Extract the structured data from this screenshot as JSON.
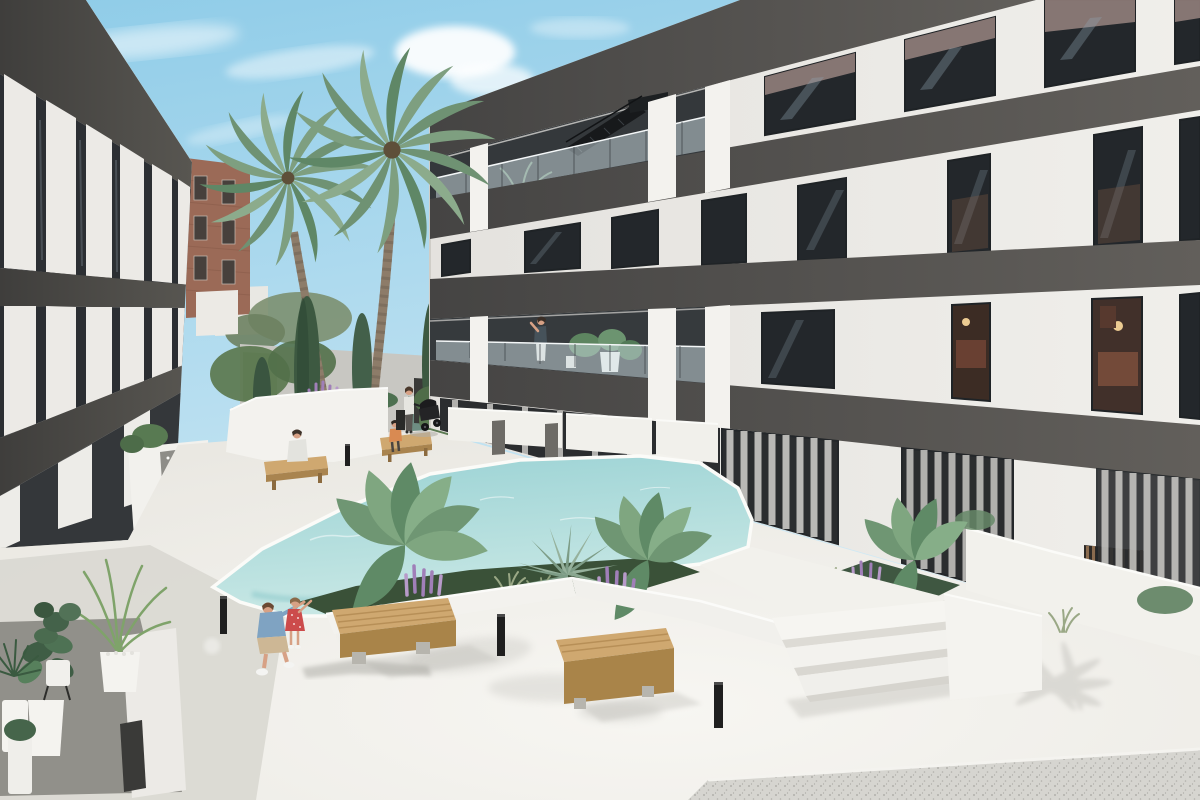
{
  "meta": {
    "title": "New-build apartment complex courtyard - photorealistic architectural render",
    "type": "3d-architectural-visualization",
    "width_px": 1200,
    "height_px": 800,
    "visible_text": "none"
  },
  "palette": {
    "sky_top": "#8fcce8",
    "sky_horizon": "#ddeff7",
    "cloud_white": "#ffffff",
    "facade_white": "#f0efeb",
    "facade_shade": "#e4e2de",
    "pillar_white": "#f3f2ee",
    "band_dark": "#454443",
    "band_lit": "#625f5b",
    "band_left_dark": "#3f3e3c",
    "band_left_lit": "#585651",
    "recess_dark": "#34383b",
    "window_glass": "#23272b",
    "window_reflection": "#8fa2b0",
    "sky_reflection_pink": "#d9b8ae",
    "interior_warm": "#3c2c24",
    "interior_furniture": "#6e4334",
    "interior_lamp": "#eccb92",
    "curtain_white": "#eae8e3",
    "glass_balustrade": "#cfe0e6",
    "pavement": "#e9e7e1",
    "pavement_bright": "#f7f6f2",
    "pavement_shadow": "#d9d8d2",
    "terrazzo_gray": "#d6d5d0",
    "pool_far": "#9ad2d4",
    "pool_near": "#c9e8e5",
    "pool_edge_aqua": "#7cc0c3",
    "coping_white": "#fbfbf8",
    "planter_white": "#f3f2ee",
    "bed_green": "#3a5138",
    "palm_green": "#7e9f80",
    "palm_green_dark": "#5f8766",
    "cypress_green": "#3d5941",
    "banana_green": "#6f9673",
    "agave_green": "#96b19c",
    "lupine_purple": "#b095c5",
    "grass_green": "#9aa886",
    "wood_top": "#cfa870",
    "wood_side": "#a98449",
    "concrete_gray": "#b7b5ae",
    "brick_red": "#9b6a57",
    "bg_wall_gray": "#c8c7c2",
    "hedge_green": "#7a9268",
    "teal_panel": "#6e8d82",
    "louver_wood": "#8a6b4e",
    "bollard_black": "#1f1f1f",
    "terrace_gray": "#91908a",
    "pot_white": "#f4f3ef",
    "skin": "#d7a185",
    "denim_blue": "#7fa3c2",
    "khaki": "#cdb795",
    "dress_red": "#cc4b4b",
    "orange_top": "#d98a52",
    "stroller_black": "#1c1c1e"
  },
  "scene": {
    "time_of_day": "sunny midday, long soft shadows toward lower-right",
    "sky": {
      "visible_region": "upper-left wedge between buildings",
      "clouds": 5
    },
    "buildings": {
      "left_wing": {
        "position": "left edge, seen at sharp angle receding right",
        "floors_visible": 3,
        "features": [
          "dark charcoal floor bands",
          "white vertical fins",
          "full-height glazing",
          "ground-floor terraces with white planter boxes"
        ]
      },
      "main_wing": {
        "position": "center to right, facade facing courtyard",
        "floors_visible": 4,
        "features": [
          "dark charcoal parapet and floor bands",
          "white piers",
          "glass balustrade balconies on top and second floor (left half)",
          "external black staircase on top floor",
          "floor-to-ceiling windows",
          "two warm-lit interiors on right",
          "ground-floor patios with low white walls",
          "wood louver screen",
          "white courtyard wall lower right"
        ]
      },
      "background": {
        "brick_building": {
          "color": "red-brown",
          "windows": 6
        },
        "misc": [
          "distant white building",
          "gray service walls",
          "green hedge panel",
          "teal panel",
          "dark doorway",
          "white utility boxes",
          "background trees"
        ]
      }
    },
    "courtyard": {
      "paving": "white concrete, terrazzo speckled strip lower right",
      "pool": {
        "shape": "irregular angular",
        "water": "turquoise",
        "coping": "white",
        "raised_deck_steps": 3
      },
      "planters": [
        "left planter with cypresses, lupines and boxwood ball",
        "central white wedge planter with bananas, agave, lupines, grasses",
        "right bed near steps"
      ],
      "benches": [
        {
          "id": "bench-left",
          "type": "wood slat",
          "occupant": "seated person"
        },
        {
          "id": "bench-mid",
          "type": "wood slat",
          "occupant": "seated child"
        },
        {
          "id": "bench-front-large",
          "type": "chunky wood block on concrete feet"
        },
        {
          "id": "bench-front-long",
          "type": "long wood slat on concrete feet"
        }
      ],
      "bollard_lights": 4,
      "potted_plants_lower_left": 6
    },
    "people": [
      {
        "id": "crouching-man",
        "desc": "man in blue shirt and khaki shorts crouching, pointing up-right",
        "area": "foreground center-left"
      },
      {
        "id": "little-girl",
        "desc": "girl in red polka-dot dress next to man",
        "area": "foreground center-left"
      },
      {
        "id": "bench-sitter",
        "desc": "person seated on left bench, back to camera",
        "area": "mid-left"
      },
      {
        "id": "bench-child",
        "desc": "child in orange top on middle bench",
        "area": "mid"
      },
      {
        "id": "stroller-woman",
        "desc": "woman standing beside black pram",
        "area": "mid walkway"
      },
      {
        "id": "balcony-woman",
        "desc": "woman standing at second-floor balcony rail",
        "area": "main building"
      }
    ],
    "vegetation": [
      "2 large date palms",
      "3 cypresses",
      "3 banana plants",
      "1 agave",
      "4 lupine clusters",
      "grass tufts",
      "areca palm in pot",
      "monstera and ficus in white pots"
    ]
  }
}
